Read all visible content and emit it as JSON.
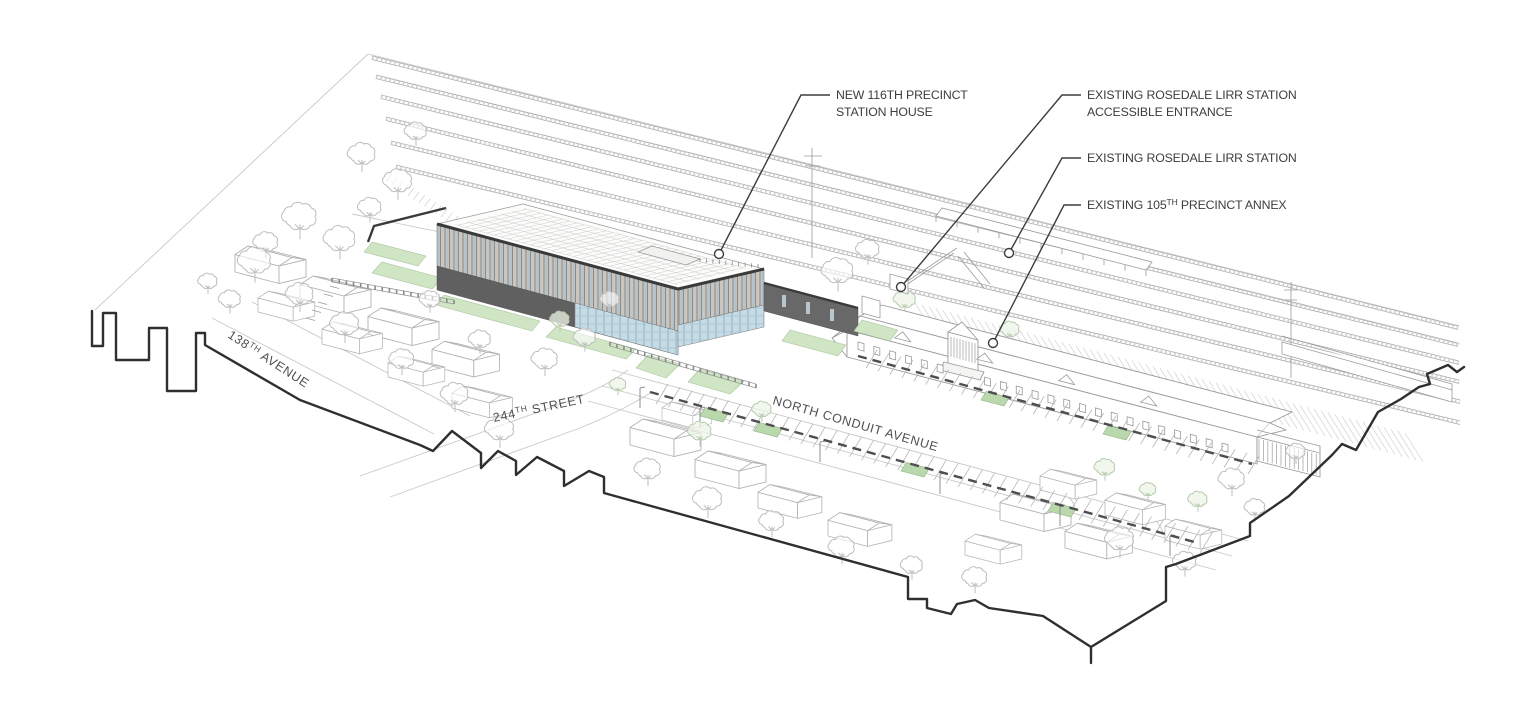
{
  "callouts": [
    {
      "line1": "NEW 116TH PRECINCT",
      "line2": "STATION HOUSE"
    },
    {
      "line1": "EXISTING ROSEDALE LIRR STATION",
      "line2": "ACCESSIBLE ENTRANCE"
    },
    {
      "line1": "EXISTING ROSEDALE LIRR STATION"
    },
    {
      "pre": "EXISTING 105",
      "sup": "TH",
      "post": " PRECINCT ANNEX"
    }
  ],
  "streets": [
    {
      "pre": "138",
      "sup": "TH",
      "post": " AVENUE"
    },
    {
      "pre": "244",
      "sup": "TH",
      "post": " STREET"
    },
    {
      "label": "NORTH CONDUIT AVENUE"
    }
  ],
  "colors": {
    "ink": "#3a3a3a",
    "line_gray": "#a8a8a8",
    "faint_gray": "#c9c9c9",
    "lawn_green": "#cfe5c4",
    "lawn_green_stroke": "#a9c29b",
    "island_green": "#b9d8ab",
    "glass_blue": "#c5dce7",
    "fin_gray": "#c9c6c1",
    "facade_dark": "#606060"
  }
}
